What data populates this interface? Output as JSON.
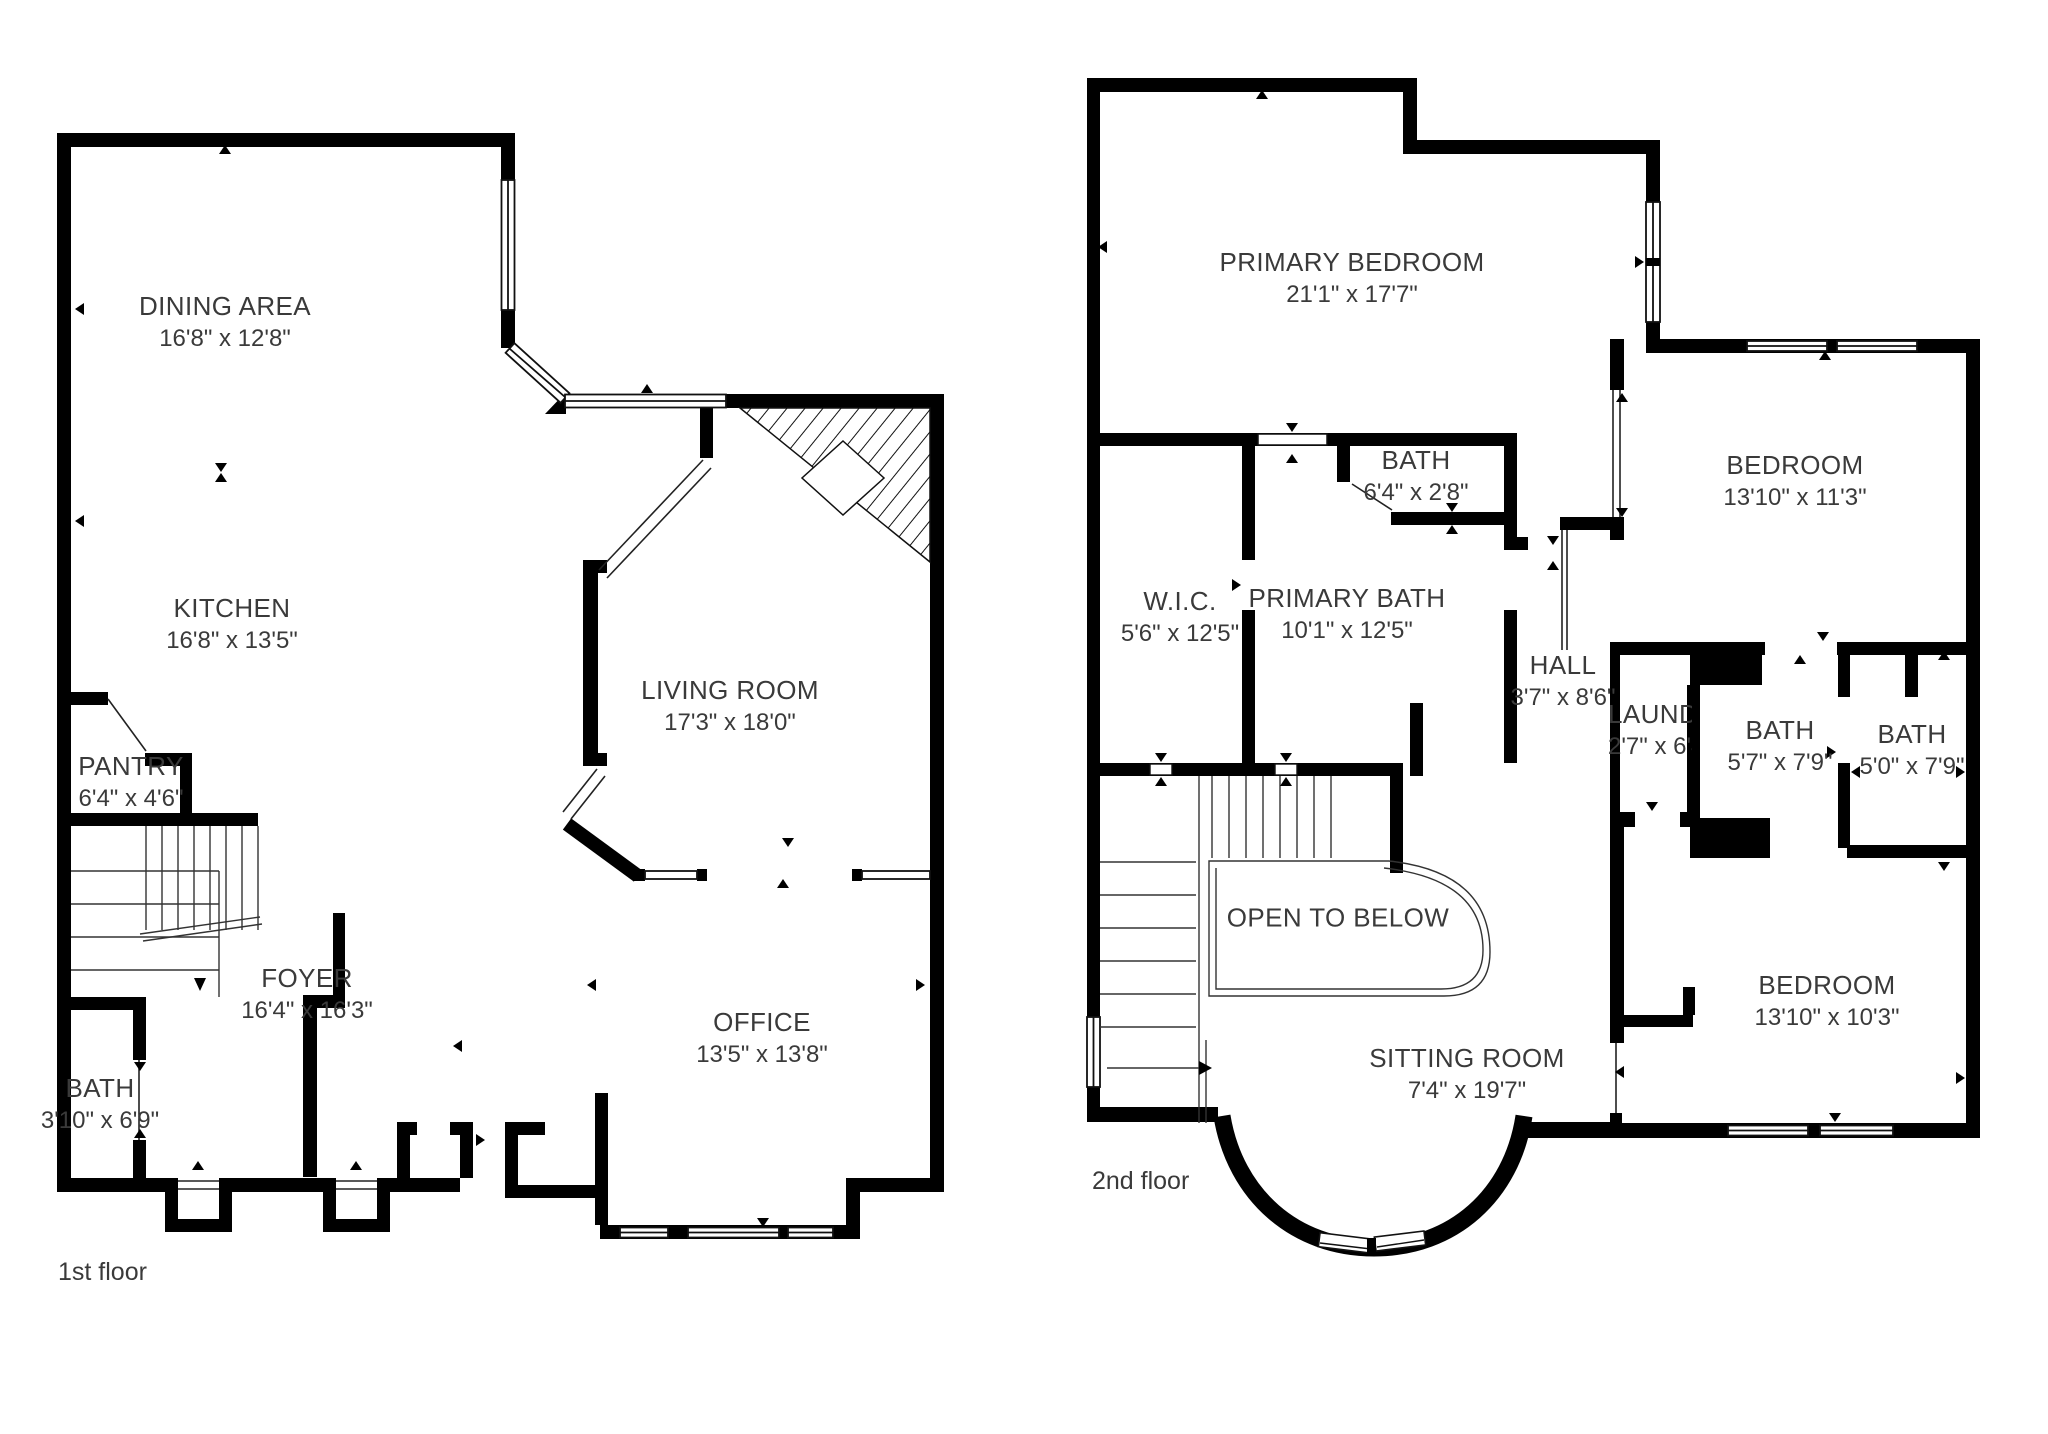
{
  "title": "Two-story house floor plan",
  "colors": {
    "wall": "#000000",
    "text": "#3a3a3a",
    "background": "#ffffff"
  },
  "floors": [
    {
      "label": "1st floor",
      "rooms": [
        {
          "name": "DINING AREA",
          "dims": "16'8\" x 12'8\""
        },
        {
          "name": "KITCHEN",
          "dims": "16'8\" x 13'5\""
        },
        {
          "name": "PANTRY",
          "dims": "6'4\" x 4'6\""
        },
        {
          "name": "LIVING ROOM",
          "dims": "17'3\" x 18'0\""
        },
        {
          "name": "FOYER",
          "dims": "16'4\" x 16'3\""
        },
        {
          "name": "BATH",
          "dims": "3'10\" x 6'9\""
        },
        {
          "name": "OFFICE",
          "dims": "13'5\" x 13'8\""
        }
      ]
    },
    {
      "label": "2nd floor",
      "rooms": [
        {
          "name": "PRIMARY BEDROOM",
          "dims": "21'1\" x 17'7\""
        },
        {
          "name": "BATH",
          "dims": "6'4\" x 2'8\""
        },
        {
          "name": "W.I.C.",
          "dims": "5'6\" x 12'5\""
        },
        {
          "name": "PRIMARY BATH",
          "dims": "10'1\" x 12'5\""
        },
        {
          "name": "HALL",
          "dims": "3'7\" x 8'6\""
        },
        {
          "name": "LAUNDRY",
          "dims": "2'7\" x 6'4\""
        },
        {
          "name": "BEDROOM",
          "dims": "13'10\" x 11'3\""
        },
        {
          "name": "BATH",
          "dims": "5'7\" x 7'9\""
        },
        {
          "name": "BATH",
          "dims": "5'0\" x 7'9\""
        },
        {
          "name": "BEDROOM",
          "dims": "13'10\" x 10'3\""
        },
        {
          "name": "OPEN TO BELOW"
        },
        {
          "name": "SITTING ROOM",
          "dims": "7'4\" x 19'7\""
        }
      ]
    }
  ]
}
